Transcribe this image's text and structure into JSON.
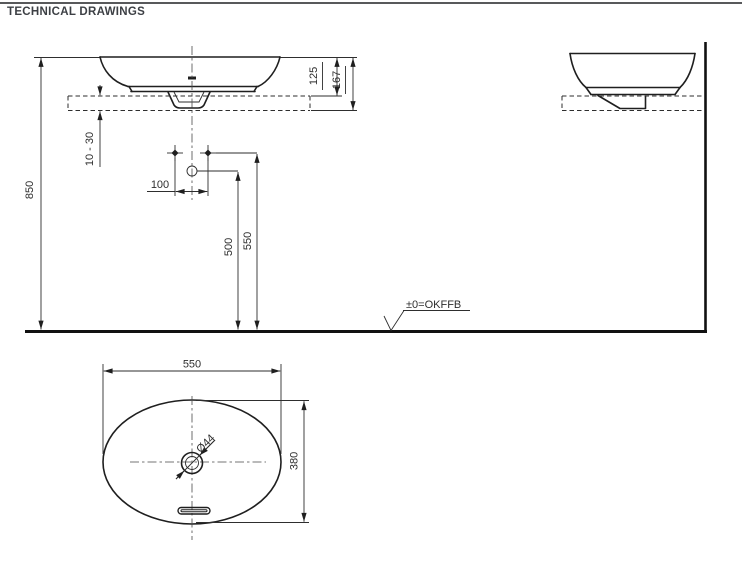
{
  "title": "TECHNICAL DRAWINGS",
  "colors": {
    "drawing_line": "#1f1f1f",
    "dimension_line": "#2e2e2e",
    "title_text": "#3d4045",
    "header_rule": "#58595b",
    "background": "#ffffff"
  },
  "views": {
    "front": {
      "dims": {
        "mounting_height": "850",
        "rim_above_counter": "125",
        "rim_to_counter_bottom": "167",
        "counter_thickness": "10 - 30",
        "tap_hole_spacing": "100",
        "outlet_height": "500",
        "tap_hole_height": "550"
      },
      "datum_label": "±0=OKFFB"
    },
    "plan": {
      "dims": {
        "basin_width": "550",
        "basin_depth": "380",
        "drain_diameter": "Ø44"
      }
    }
  }
}
